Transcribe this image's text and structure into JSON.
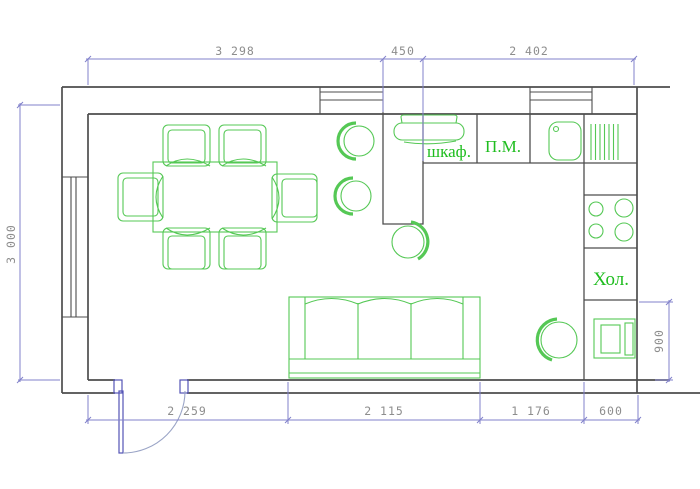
{
  "labels": {
    "cabinet": "шкаф.",
    "dishwasher": "П.М.",
    "fridge": "Хол."
  },
  "dimensions": {
    "top": [
      "3 298",
      "450",
      "2 402"
    ],
    "bottom": [
      "2 259",
      "2 115",
      "1 176",
      "600"
    ],
    "left": "3 000",
    "right": "900"
  },
  "colors": {
    "background": "#ffffff",
    "wall": "#4d4d4d",
    "furniture": "#55c855",
    "label": "#1fbd1f",
    "dimline": "#8282cb",
    "dimtext": "#8d8d8d",
    "door": "#5454b6",
    "doorarc": "#9aa4c6"
  }
}
